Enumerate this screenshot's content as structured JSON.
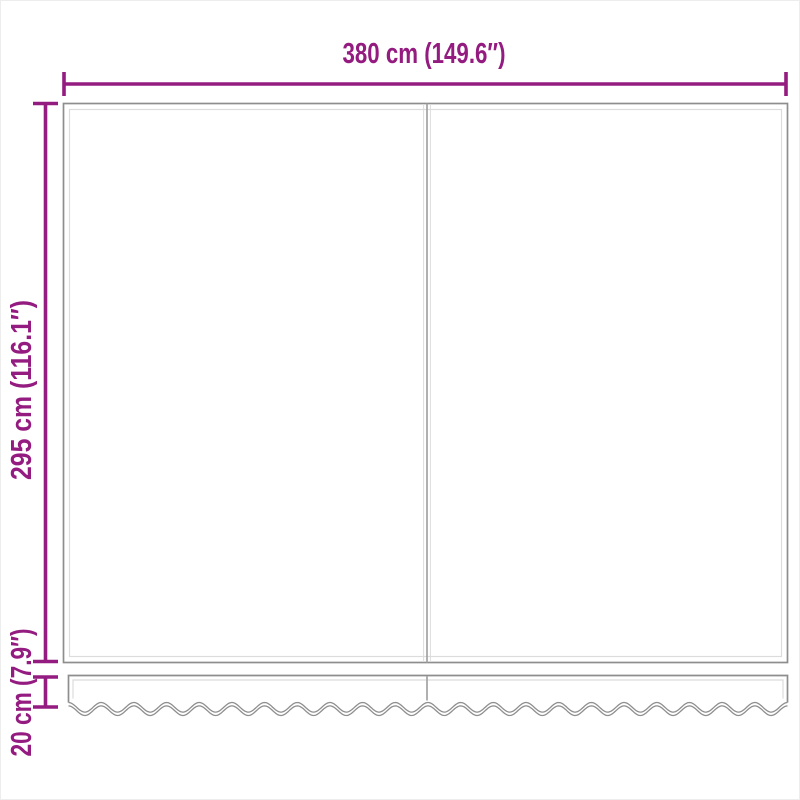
{
  "diagram": {
    "colors": {
      "accent": "#941b80",
      "outline": "#8e8e8e",
      "seam": "#dcdcdc",
      "divider": "#a2a2a2",
      "page_bg": "#ffffff"
    },
    "labels": {
      "width": "380 cm (149.6″)",
      "height": "295 cm (116.1″)",
      "valance_height": "20 cm (7.9″)"
    },
    "panel_count": 2
  }
}
